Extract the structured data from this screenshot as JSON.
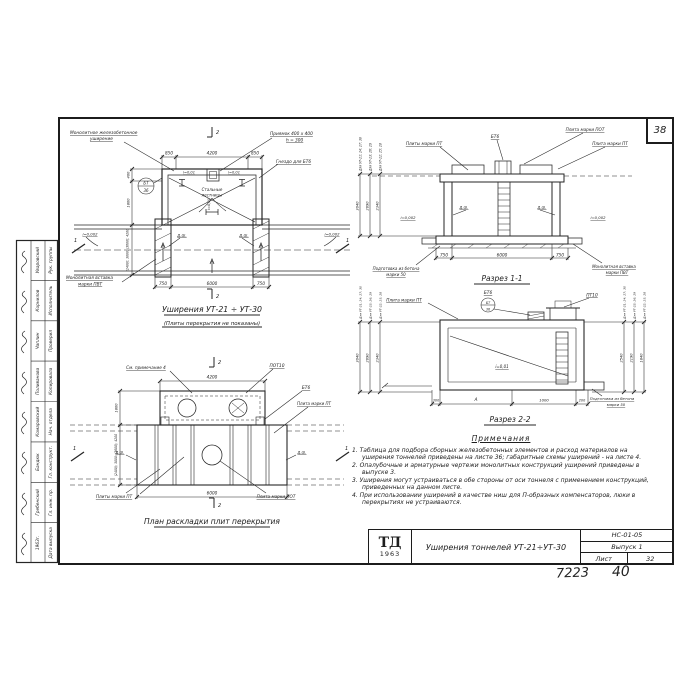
{
  "colors": {
    "ink": "#1e1e1e",
    "paper": "#ffffff"
  },
  "page": {
    "corner_sheet_number": "38",
    "handwritten_left": "7223",
    "handwritten_right": "40"
  },
  "title_block": {
    "logo_top": "ТД",
    "logo_year": "1963",
    "title": "Уширения тоннелей УТ-21÷УТ-30",
    "doc_number": "НС-01-05",
    "issue": "Выпуск 1",
    "sheet_label": "Лист",
    "sheet_number": "32"
  },
  "stamp": {
    "entries": [
      {
        "role": "Дата выпуска",
        "name": "1963г."
      },
      {
        "role": "Гл. инж. пр.",
        "name": "Гребенский"
      },
      {
        "role": "Гл. конструкт.",
        "name": "Бандюк"
      },
      {
        "role": "Нач. отдела",
        "name": "Комаровский"
      },
      {
        "role": "Копировала",
        "name": "Поливанова"
      },
      {
        "role": "Проверил",
        "name": "Чаплин"
      },
      {
        "role": "Исполнитель",
        "name": "Корнилов"
      },
      {
        "role": "Рук. группы",
        "name": "Уваровский"
      }
    ]
  },
  "plan": {
    "title": "Уширения УТ-21 ÷ УТ-30",
    "subtitle": "(Плиты перекрытия не показаны)",
    "labels": {
      "monolith1": "Монолитное железобетонное",
      "monolith2": "уширение",
      "pit1": "Приямок 400 x 400",
      "pit2": "h = 300",
      "socket": "Гнездо для БТ6",
      "stairs1": "Стальные",
      "stairs2": "лестницы",
      "insert1": "Монолитная вставка",
      "insert2": "марки ПВТ",
      "joint": "д.ш.",
      "slope01": "i=0,01",
      "slope002": "i=0,002",
      "callout_top": "БТ",
      "callout_bot": "36"
    },
    "dims": {
      "d850": "850",
      "d4200": "4200",
      "d750": "750",
      "d6000": "6000",
      "d400": "400",
      "d1800": "1800",
      "width_variants": "(2400); 3000; (3600); 4200"
    },
    "marks": {
      "s1": "1",
      "s2": "2"
    }
  },
  "section11": {
    "title": "Разрез 1-1",
    "labels": {
      "bt6": "БТ6",
      "plate_pot": "Плита марки ПОТ",
      "plates_pt": "Плиты марки ПТ",
      "plate_pt": "Плита марки ПТ",
      "base1": "Подготовка из бетона",
      "base2": "марки 50",
      "insert1": "Монолитная вставка",
      "insert2": "марки ПВТ",
      "joint": "д.ш.",
      "slope002": "i=0,002"
    },
    "dims": {
      "d750": "750",
      "d6000": "6000"
    },
    "height_dims": [
      {
        "for": "Для УТ-21; 24; 27; 30",
        "value": "3040"
      },
      {
        "for": "Для УТ-23; 26; 29",
        "value": "2690"
      },
      {
        "for": "Для УТ-22; 25; 28",
        "value": "2340"
      }
    ]
  },
  "section22": {
    "title": "Разрез 2-2",
    "labels": {
      "plate_pt": "Плита марки ПТ",
      "bt6": "БТ6",
      "pt10": "ПТ10",
      "slope01": "i=0,01",
      "base1": "Подготовка из бетона",
      "base2": "марки 50",
      "callout_top": "БТ",
      "callout_bot": "36"
    },
    "dims": {
      "d300": "300",
      "dA": "А",
      "d1000": "1000",
      "d200": "200"
    },
    "height_dims_left": [
      {
        "for": "Для УТ-21; 24; 27; 30",
        "value": "3040"
      },
      {
        "for": "Для УТ-23; 26; 29",
        "value": "2690"
      },
      {
        "for": "Для УТ-22; 25; 28",
        "value": "2340"
      }
    ],
    "height_dims_right": [
      {
        "for": "Для УТ-21; 24; 27; 30",
        "value": "2540"
      },
      {
        "for": "Для УТ-23; 26; 29",
        "value": "2190"
      },
      {
        "for": "Для УТ-22; 25; 28",
        "value": "1840"
      }
    ]
  },
  "slab_plan": {
    "title": "План раскладки плит перекрытия",
    "labels": {
      "note4": "См. примечание 4",
      "pot10": "ПОТ10",
      "bt6": "БТ6",
      "plate_pt": "Плита марки ПТ",
      "plates_pt": "Плиты марки ПТ",
      "plate_pot": "Плита марки ПОТ",
      "joint": "д.ш."
    },
    "dims": {
      "d4200": "4200",
      "d6000": "6000",
      "d1800": "1800",
      "width_variants": "(2400); 3000; (3600); 4200"
    },
    "marks": {
      "s1": "1",
      "s2": "2"
    }
  },
  "notes": {
    "heading": "Примечания",
    "items": [
      "1. Таблица для подбора сборных железобетонных элементов и расход материалов на уширения тоннелей приведены на листе 36; габаритные схемы уширений - на листе 4.",
      "2. Опалубочные и арматурные чертежи монолитных конструкций уширений приведены в выпуске 3.",
      "3. Уширения могут устраиваться в обе стороны от оси тоннеля с применением конструкций, приведенных на данном листе.",
      "4. При использовании уширений в качестве ниш для П-образных компенсаторов, люки в перекрытиях не устраиваются."
    ]
  }
}
